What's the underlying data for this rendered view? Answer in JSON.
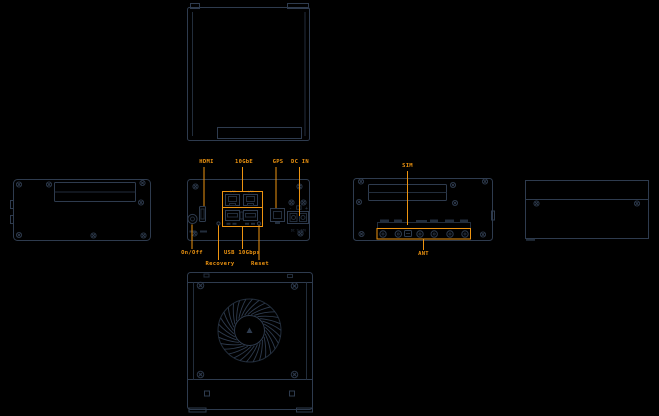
{
  "colors": {
    "background": "#000000",
    "line": "#2e3b4e",
    "line_soft": "#222d3b",
    "accent": "#ee9410"
  },
  "front_panel": {
    "labels_top": [
      {
        "text": "HDMI"
      },
      {
        "text": "10GbE"
      },
      {
        "text": "GPS"
      },
      {
        "text": "DC IN"
      }
    ],
    "labels_bottom": [
      {
        "text": "On/Off"
      },
      {
        "text": "Recovery"
      },
      {
        "text": "USB 10Gbps"
      },
      {
        "text": "Reset"
      }
    ],
    "port_tags": {
      "left": "LAN",
      "right": "LAN"
    },
    "dc": {
      "minus": "-",
      "plus": "+",
      "rating": "DC 9-36V"
    }
  },
  "antenna_panel": {
    "sim": "SIM",
    "ant": "ANT"
  }
}
